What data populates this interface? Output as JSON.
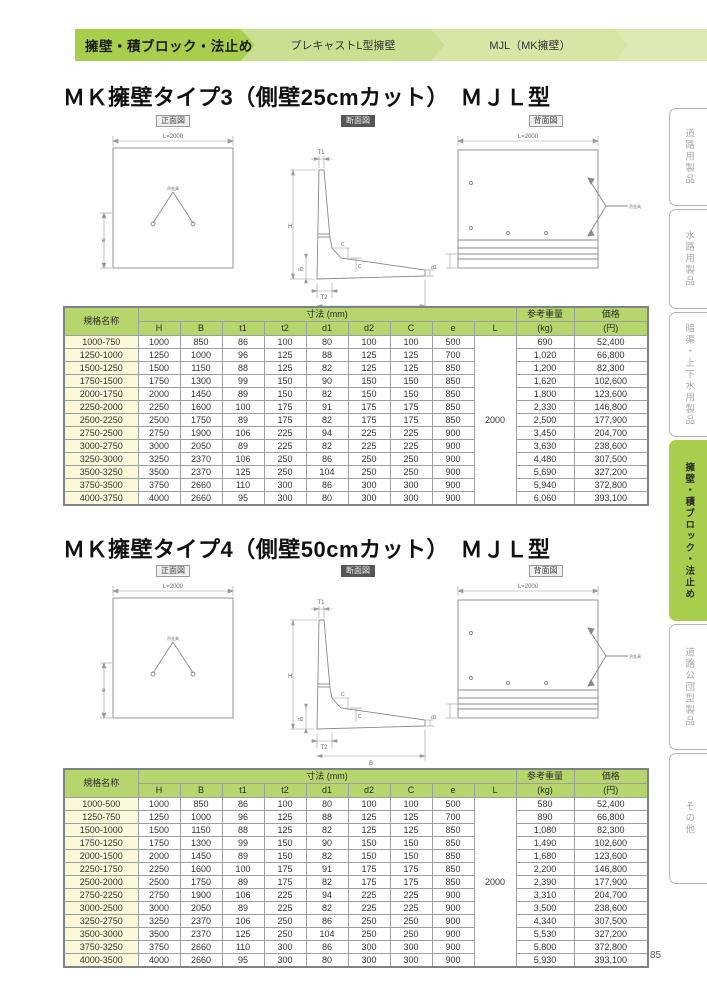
{
  "page": {
    "number": "85"
  },
  "breadcrumb": {
    "items": [
      {
        "label": "擁壁・積ブロック・法止め"
      },
      {
        "label": "プレキャストL型擁壁"
      },
      {
        "label": "MJL（MK擁壁）"
      }
    ]
  },
  "sidebar": {
    "tabs": [
      {
        "label": "道路用製品",
        "active": false
      },
      {
        "label": "水路用製品",
        "active": false
      },
      {
        "label": "暗渠・上下水用製品",
        "active": false
      },
      {
        "label": "擁壁・積ブロック・法止め",
        "active": true
      },
      {
        "label": "道路公団型製品",
        "active": false
      },
      {
        "label": "その他",
        "active": false
      }
    ]
  },
  "diagram_labels": {
    "front": "正面図",
    "section": "断面図",
    "back": "背面図",
    "front_dim": "L=2000",
    "back_dim": "L=2000",
    "front_side_dim": "e",
    "anchor_label": "吊金具",
    "dim_T1": "T1",
    "dim_H": "H",
    "dim_T2": "T2",
    "dim_B": "B",
    "dim_C": "C",
    "dim_d1": "d1",
    "dim_d2": "d2"
  },
  "sections": [
    {
      "title": "ＭＫ擁壁タイプ3（側壁25cmカット）　ＭＪＬ型",
      "table": {
        "name_header": "規格名称",
        "dims_header": "寸法 (mm)",
        "dim_headers": [
          "H",
          "B",
          "t1",
          "t2",
          "d1",
          "d2",
          "C",
          "e",
          "L"
        ],
        "weight_header": "参考重量",
        "weight_unit": "(kg)",
        "price_header": "価格",
        "price_unit": "(円)",
        "L_value": "2000",
        "rows": [
          {
            "name": "1000-750",
            "H": "1000",
            "B": "850",
            "t1": "86",
            "t2": "100",
            "d1": "80",
            "d2": "100",
            "C": "100",
            "e": "500",
            "weight": "690",
            "price": "52,400"
          },
          {
            "name": "1250-1000",
            "H": "1250",
            "B": "1000",
            "t1": "96",
            "t2": "125",
            "d1": "88",
            "d2": "125",
            "C": "125",
            "e": "700",
            "weight": "1,020",
            "price": "66,800"
          },
          {
            "name": "1500-1250",
            "H": "1500",
            "B": "1150",
            "t1": "88",
            "t2": "125",
            "d1": "82",
            "d2": "125",
            "C": "125",
            "e": "850",
            "weight": "1,200",
            "price": "82,300"
          },
          {
            "name": "1750-1500",
            "H": "1750",
            "B": "1300",
            "t1": "99",
            "t2": "150",
            "d1": "90",
            "d2": "150",
            "C": "150",
            "e": "850",
            "weight": "1,620",
            "price": "102,600"
          },
          {
            "name": "2000-1750",
            "H": "2000",
            "B": "1450",
            "t1": "89",
            "t2": "150",
            "d1": "82",
            "d2": "150",
            "C": "150",
            "e": "850",
            "weight": "1,800",
            "price": "123,600"
          },
          {
            "name": "2250-2000",
            "H": "2250",
            "B": "1600",
            "t1": "100",
            "t2": "175",
            "d1": "91",
            "d2": "175",
            "C": "175",
            "e": "850",
            "weight": "2,330",
            "price": "146,800"
          },
          {
            "name": "2500-2250",
            "H": "2500",
            "B": "1750",
            "t1": "89",
            "t2": "175",
            "d1": "82",
            "d2": "175",
            "C": "175",
            "e": "850",
            "weight": "2,500",
            "price": "177,900"
          },
          {
            "name": "2750-2500",
            "H": "2750",
            "B": "1900",
            "t1": "106",
            "t2": "225",
            "d1": "94",
            "d2": "225",
            "C": "225",
            "e": "900",
            "weight": "3,450",
            "price": "204,700"
          },
          {
            "name": "3000-2750",
            "H": "3000",
            "B": "2050",
            "t1": "89",
            "t2": "225",
            "d1": "82",
            "d2": "225",
            "C": "225",
            "e": "900",
            "weight": "3,630",
            "price": "238,600"
          },
          {
            "name": "3250-3000",
            "H": "3250",
            "B": "2370",
            "t1": "106",
            "t2": "250",
            "d1": "86",
            "d2": "250",
            "C": "250",
            "e": "900",
            "weight": "4,480",
            "price": "307,500"
          },
          {
            "name": "3500-3250",
            "H": "3500",
            "B": "2370",
            "t1": "125",
            "t2": "250",
            "d1": "104",
            "d2": "250",
            "C": "250",
            "e": "900",
            "weight": "5,690",
            "price": "327,200"
          },
          {
            "name": "3750-3500",
            "H": "3750",
            "B": "2660",
            "t1": "110",
            "t2": "300",
            "d1": "86",
            "d2": "300",
            "C": "300",
            "e": "900",
            "weight": "5,940",
            "price": "372,800"
          },
          {
            "name": "4000-3750",
            "H": "4000",
            "B": "2660",
            "t1": "95",
            "t2": "300",
            "d1": "80",
            "d2": "300",
            "C": "300",
            "e": "900",
            "weight": "6,060",
            "price": "393,100"
          }
        ]
      }
    },
    {
      "title": "ＭＫ擁壁タイプ4（側壁50cmカット）　ＭＪＬ型",
      "table": {
        "name_header": "規格名称",
        "dims_header": "寸法 (mm)",
        "dim_headers": [
          "H",
          "B",
          "t1",
          "t2",
          "d1",
          "d2",
          "C",
          "e",
          "L"
        ],
        "weight_header": "参考重量",
        "weight_unit": "(kg)",
        "price_header": "価格",
        "price_unit": "(円)",
        "L_value": "2000",
        "rows": [
          {
            "name": "1000-500",
            "H": "1000",
            "B": "850",
            "t1": "86",
            "t2": "100",
            "d1": "80",
            "d2": "100",
            "C": "100",
            "e": "500",
            "weight": "580",
            "price": "52,400"
          },
          {
            "name": "1250-750",
            "H": "1250",
            "B": "1000",
            "t1": "96",
            "t2": "125",
            "d1": "88",
            "d2": "125",
            "C": "125",
            "e": "700",
            "weight": "890",
            "price": "66,800"
          },
          {
            "name": "1500-1000",
            "H": "1500",
            "B": "1150",
            "t1": "88",
            "t2": "125",
            "d1": "82",
            "d2": "125",
            "C": "125",
            "e": "850",
            "weight": "1,080",
            "price": "82,300"
          },
          {
            "name": "1750-1250",
            "H": "1750",
            "B": "1300",
            "t1": "99",
            "t2": "150",
            "d1": "90",
            "d2": "150",
            "C": "150",
            "e": "850",
            "weight": "1,490",
            "price": "102,600"
          },
          {
            "name": "2000-1500",
            "H": "2000",
            "B": "1450",
            "t1": "89",
            "t2": "150",
            "d1": "82",
            "d2": "150",
            "C": "150",
            "e": "850",
            "weight": "1,680",
            "price": "123,600"
          },
          {
            "name": "2250-1750",
            "H": "2250",
            "B": "1600",
            "t1": "100",
            "t2": "175",
            "d1": "91",
            "d2": "175",
            "C": "175",
            "e": "850",
            "weight": "2,200",
            "price": "146,800"
          },
          {
            "name": "2500-2000",
            "H": "2500",
            "B": "1750",
            "t1": "89",
            "t2": "175",
            "d1": "82",
            "d2": "175",
            "C": "175",
            "e": "850",
            "weight": "2,390",
            "price": "177,900"
          },
          {
            "name": "2750-2250",
            "H": "2750",
            "B": "1900",
            "t1": "106",
            "t2": "225",
            "d1": "94",
            "d2": "225",
            "C": "225",
            "e": "900",
            "weight": "3,310",
            "price": "204,700"
          },
          {
            "name": "3000-2500",
            "H": "3000",
            "B": "2050",
            "t1": "89",
            "t2": "225",
            "d1": "82",
            "d2": "225",
            "C": "225",
            "e": "900",
            "weight": "3,500",
            "price": "238,600"
          },
          {
            "name": "3250-2750",
            "H": "3250",
            "B": "2370",
            "t1": "106",
            "t2": "250",
            "d1": "86",
            "d2": "250",
            "C": "250",
            "e": "900",
            "weight": "4,340",
            "price": "307,500"
          },
          {
            "name": "3500-3000",
            "H": "3500",
            "B": "2370",
            "t1": "125",
            "t2": "250",
            "d1": "104",
            "d2": "250",
            "C": "250",
            "e": "900",
            "weight": "5,530",
            "price": "327,200"
          },
          {
            "name": "3750-3250",
            "H": "3750",
            "B": "2660",
            "t1": "110",
            "t2": "300",
            "d1": "86",
            "d2": "300",
            "C": "300",
            "e": "900",
            "weight": "5,800",
            "price": "372,800"
          },
          {
            "name": "4000-3500",
            "H": "4000",
            "B": "2660",
            "t1": "95",
            "t2": "300",
            "d1": "80",
            "d2": "300",
            "C": "300",
            "e": "900",
            "weight": "5,930",
            "price": "393,100"
          }
        ]
      }
    }
  ]
}
